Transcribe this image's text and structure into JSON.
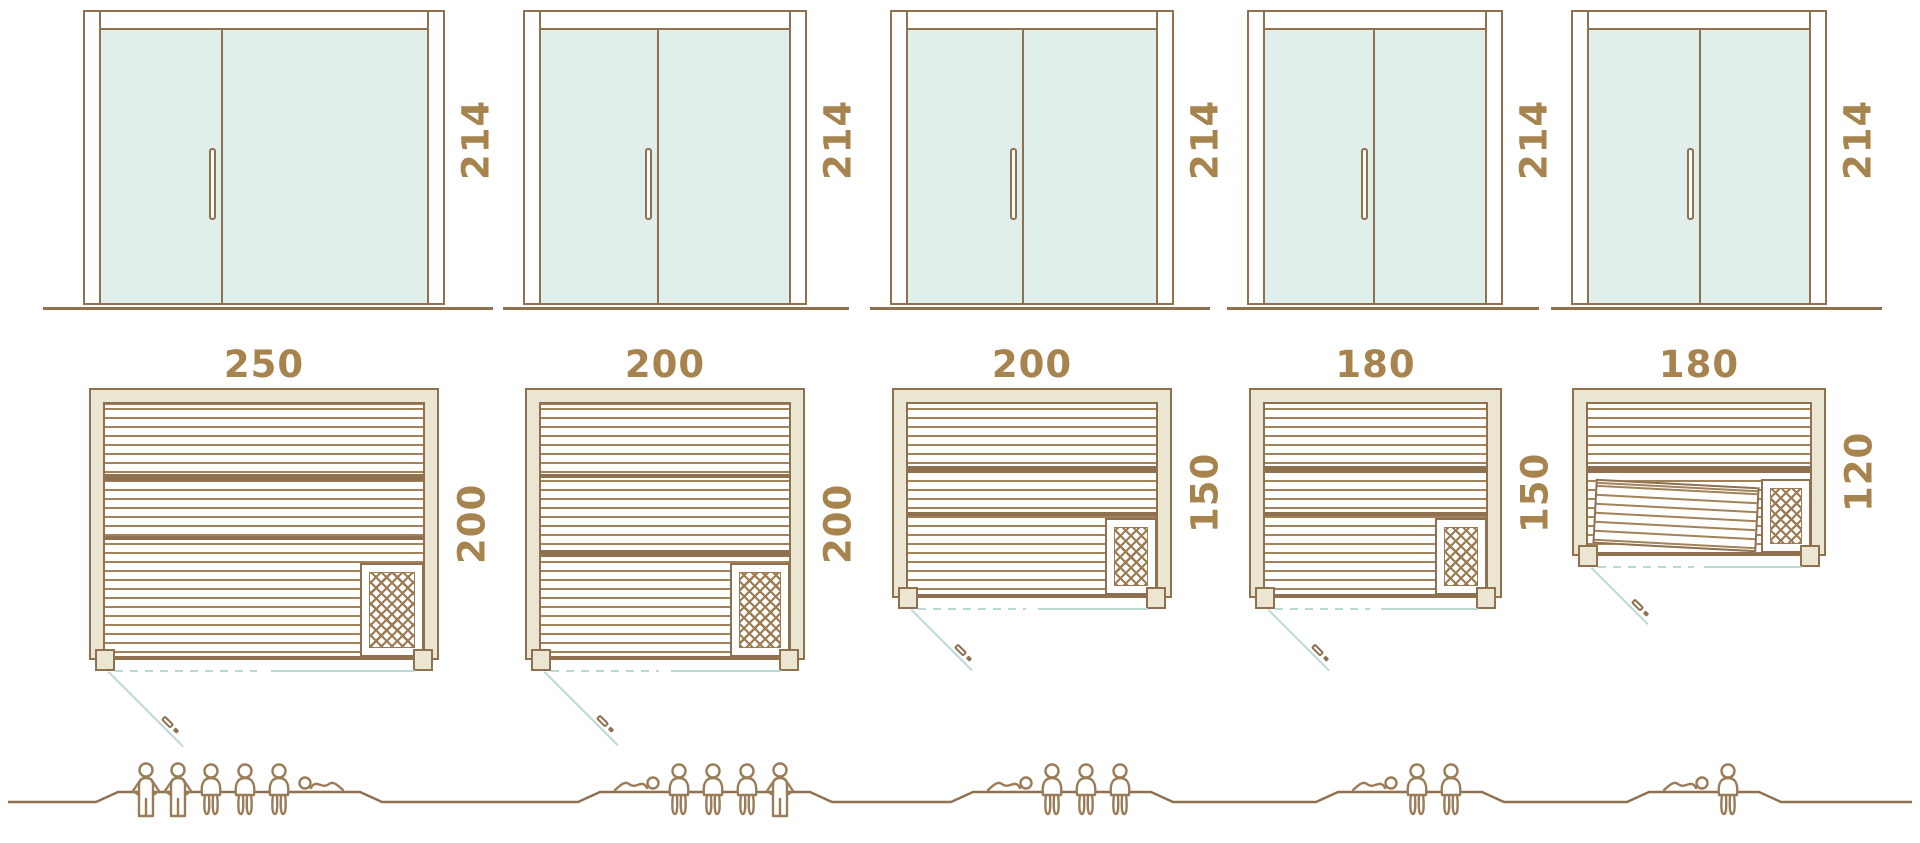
{
  "colors": {
    "outline_brown": "#8f7150",
    "stripe_brown": "#a28258",
    "dimension_label_brown": "#a7834e",
    "glass_teal": "#e0efec",
    "wall_beige": "#eae6d1",
    "door_swing_teal": "#b9d9d4"
  },
  "units": [
    {
      "name": "sauna-250x200",
      "door_height_label": "214",
      "width_label": "250",
      "depth_label": "200",
      "capacity": 6,
      "figures": [
        "standing",
        "standing",
        "sitting",
        "sitting",
        "sitting",
        "lying-head-left"
      ],
      "tilted_bench": false
    },
    {
      "name": "sauna-200x200",
      "door_height_label": "214",
      "width_label": "200",
      "depth_label": "200",
      "capacity": 5,
      "figures": [
        "lying-head-right",
        "sitting",
        "sitting",
        "sitting",
        "standing"
      ],
      "tilted_bench": false
    },
    {
      "name": "sauna-200x150",
      "door_height_label": "214",
      "width_label": "200",
      "depth_label": "150",
      "capacity": 4,
      "figures": [
        "lying-head-right",
        "sitting",
        "sitting",
        "sitting"
      ],
      "tilted_bench": false
    },
    {
      "name": "sauna-180x150",
      "door_height_label": "214",
      "width_label": "180",
      "depth_label": "150",
      "capacity": 3,
      "figures": [
        "lying-head-right",
        "sitting",
        "sitting"
      ],
      "tilted_bench": false
    },
    {
      "name": "sauna-180x120",
      "door_height_label": "214",
      "width_label": "180",
      "depth_label": "120",
      "capacity": 2,
      "figures": [
        "lying-head-right",
        "sitting"
      ],
      "tilted_bench": true
    }
  ]
}
